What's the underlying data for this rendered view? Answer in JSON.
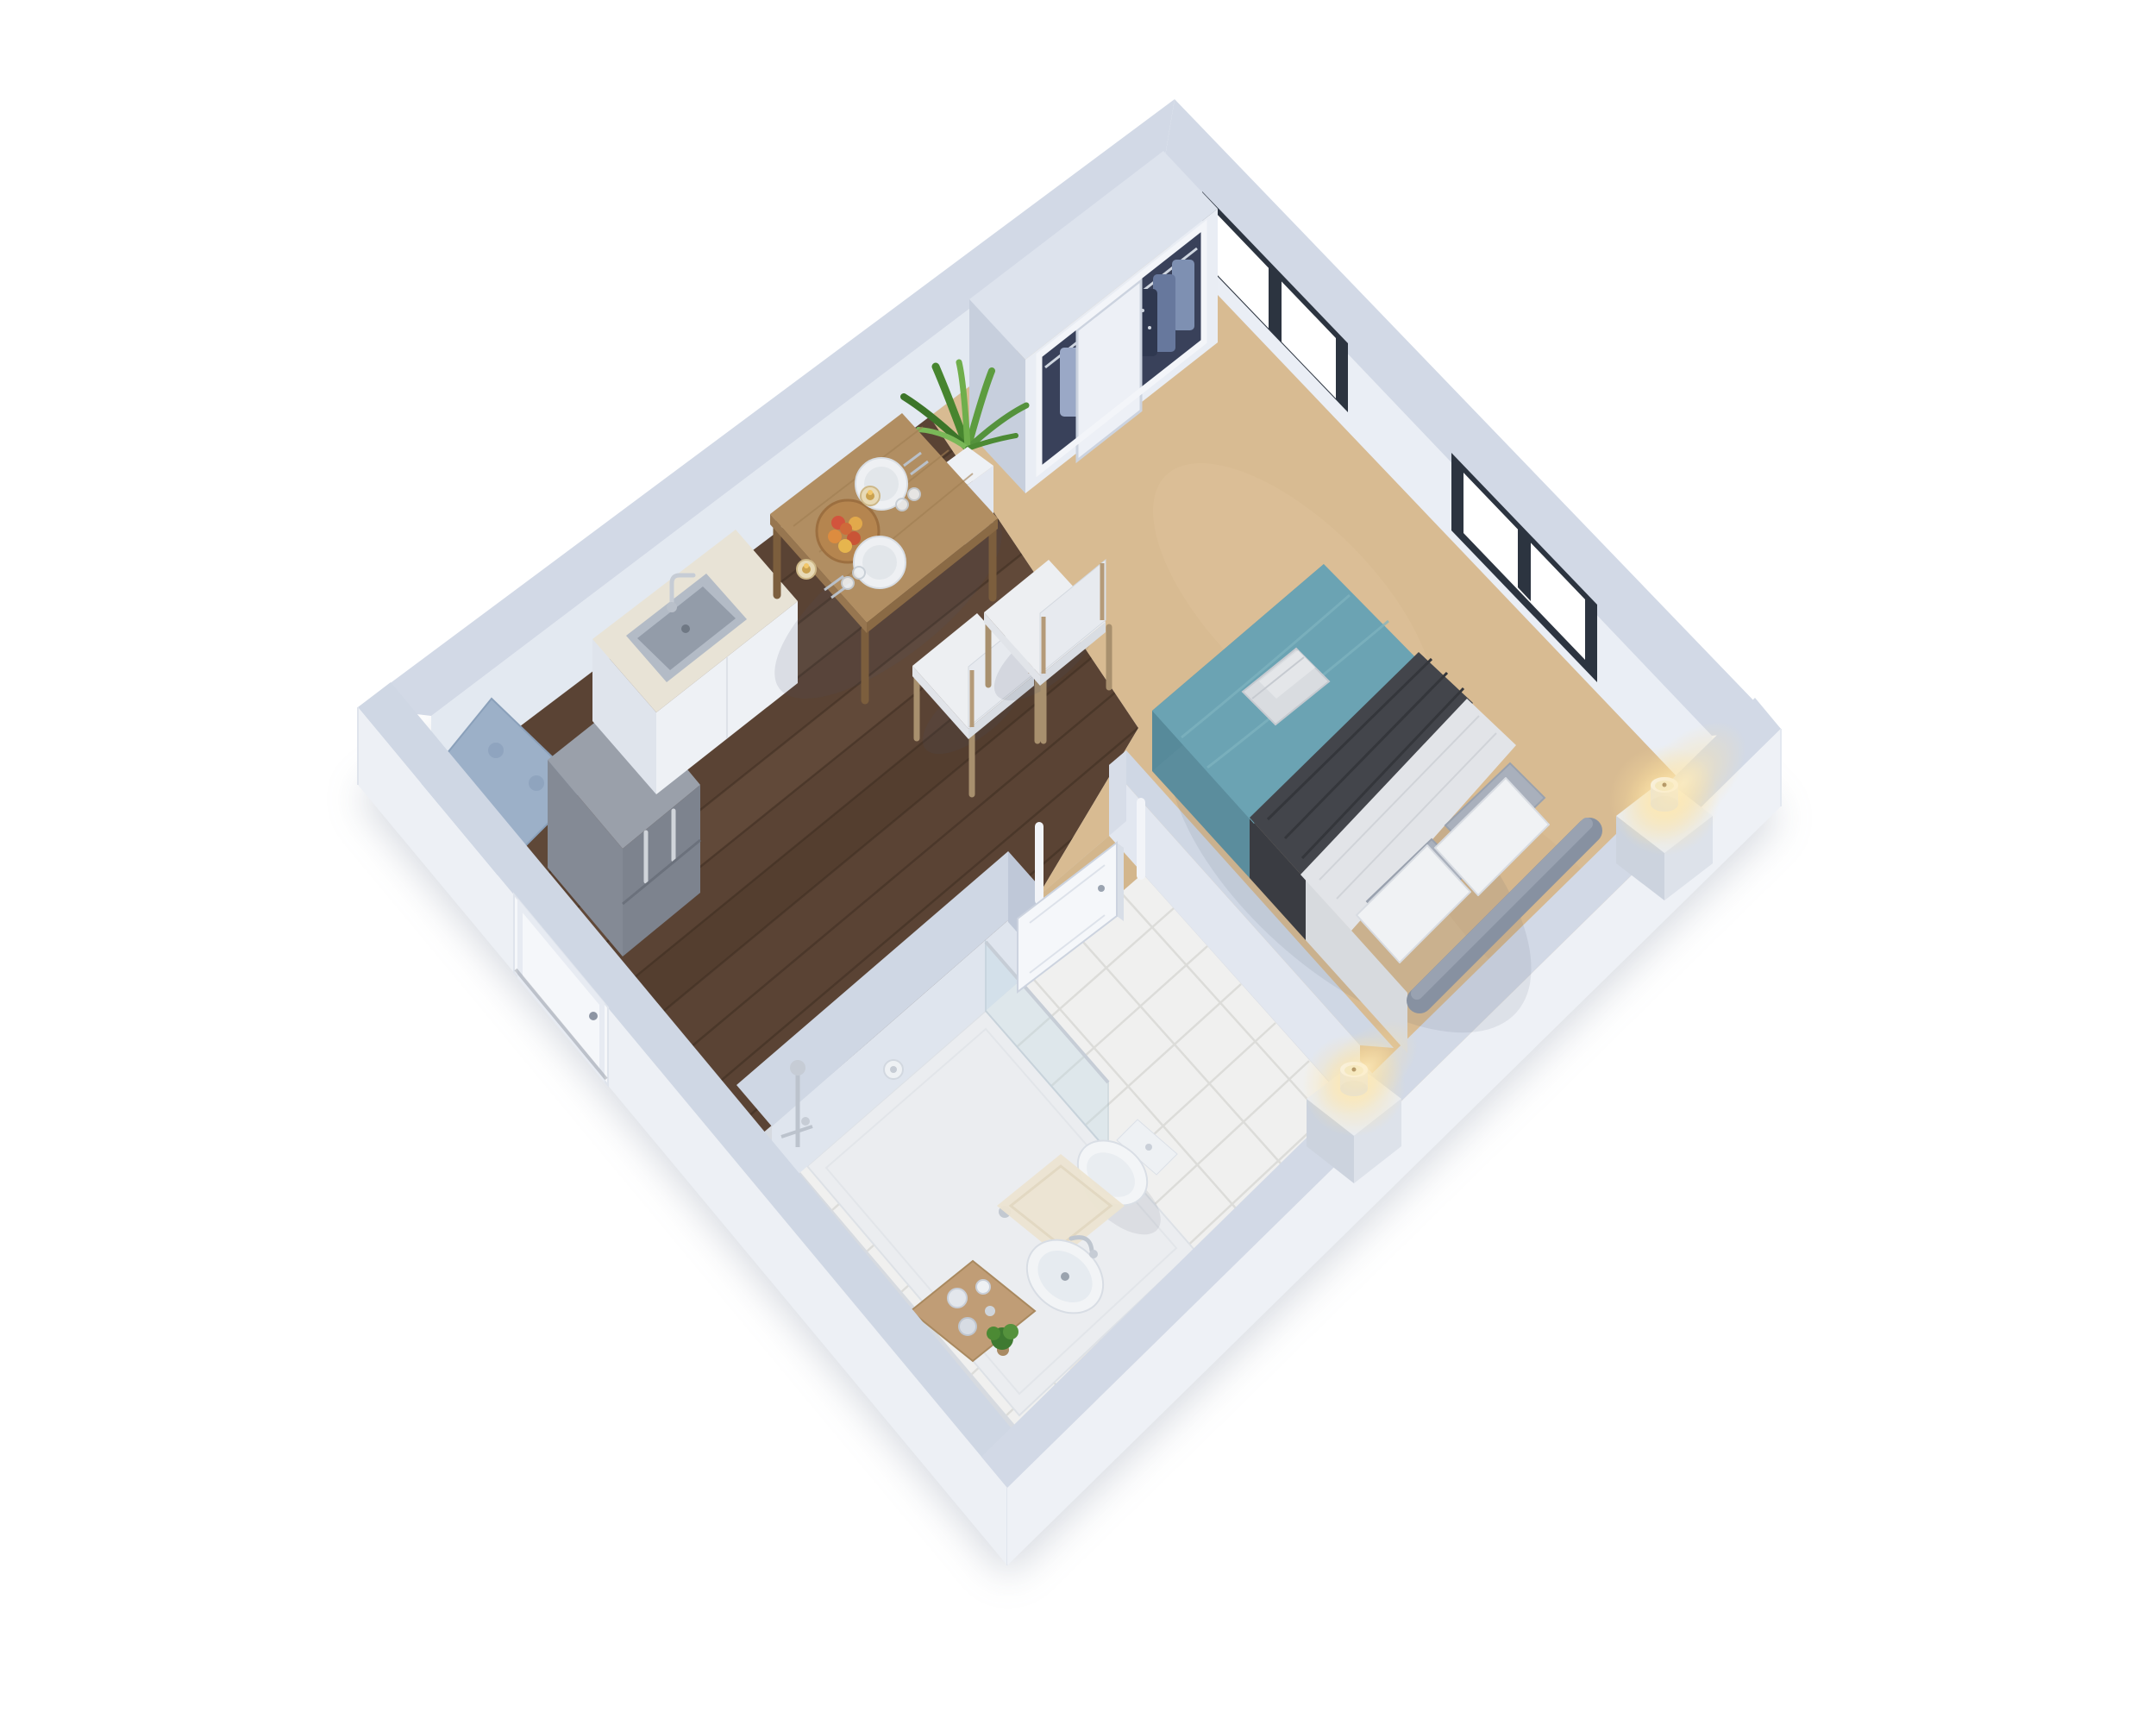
{
  "meta": {
    "type": "isometric-3d-floor-plan",
    "subject": "studio apartment",
    "visible_text": "none"
  },
  "scene": {
    "rooms": [
      {
        "name": "kitchen-dining",
        "floor": "dark-wood-planks"
      },
      {
        "name": "bedroom",
        "floor": "beige-carpet"
      },
      {
        "name": "bathroom",
        "floor": "white-tile"
      }
    ],
    "furniture": [
      "cooktop",
      "refrigerator",
      "kitchen-counter-with-sink",
      "dining-table",
      "fruit-plate",
      "place-settings",
      "table-candles",
      "dining-chair-1",
      "dining-chair-2",
      "wardrobe-closet-with-clothes",
      "sliding-closet-door",
      "potted-plant",
      "double-bed",
      "teal-duvet",
      "charcoal-throw-blanket",
      "folded-towels",
      "pillows",
      "upholstered-headboard",
      "nightstand-left",
      "nightstand-right",
      "lit-candle-left",
      "lit-candle-right",
      "shower-tray",
      "shower-glass-panel",
      "shower-fixture",
      "toilet",
      "vessel-sink",
      "wooden-vanity-tray",
      "toiletry-jars",
      "small-plant",
      "bath-rug",
      "entry-door",
      "bathroom-door-open"
    ],
    "openings": [
      "window-1-two-pane",
      "window-2-two-pane",
      "entry-door",
      "bathroom-doorway",
      "closet-opening"
    ]
  },
  "palette": {
    "background": "#ffffff",
    "wallTop": "#d2d9e6",
    "wallTopNear": "#cfd7e4",
    "wallInnerUL": "#e3e9f1",
    "wallInnerUR": "#eaeef5",
    "wallOuter": "#edf0f5",
    "wallOuterR": "#eef1f6",
    "wallFaceShade": "#bfc8d8",
    "windowFrame": "#2c3440",
    "glassWhite": "#ffffff",
    "woodFloor": "#5a4334",
    "woodSeam": "#3f2e22",
    "carpet": "#d8bb92",
    "threshold": "#d3b68c",
    "tile": "#f0f0ef",
    "tileGrout": "#dcdcd9",
    "bedTeal": "#6ba3b3",
    "bedTealSide": "#5b8d9d",
    "blanketCharcoal": "#43454b",
    "sheetWhite": "#e2e4e8",
    "pillowWhite": "#f0f2f4",
    "pillowGray": "#a9b0bc",
    "headboardGray": "#8791a1",
    "towelGray": "#d9dce0",
    "tableWood": "#b18e62",
    "tableWoodEdge": "#8a6a45",
    "chairCushion": "#edeff2",
    "chairWood": "#b49a78",
    "counterMarble": "#e8e3d6",
    "cabinetWhite": "#eef1f5",
    "stainlessTop": "#9aa0aa",
    "stainlessFront": "#7d838e",
    "stoveTop": "#9cb0c8",
    "sinkSteel": "#b3bbc6",
    "chrome": "#bcc3cd",
    "porcelain": "#f3f5f7",
    "vanityWood": "#c09d76",
    "rugCream": "#ece4d1",
    "plantGreen": "#47852f",
    "plantGreenLight": "#6fae4b",
    "potWhite": "#eef1f5",
    "doorWhite": "#f5f7fa",
    "closetFront": "#e9edf4",
    "closetInterior": "#39415a",
    "clothesBlue": "#7e90b2",
    "clothesNavy": "#3a4663",
    "clothesTan": "#c2b28f",
    "candleWax": "#efe9cc",
    "candleGlow": "#ffe8b0",
    "shadow": "#8c96a8"
  }
}
